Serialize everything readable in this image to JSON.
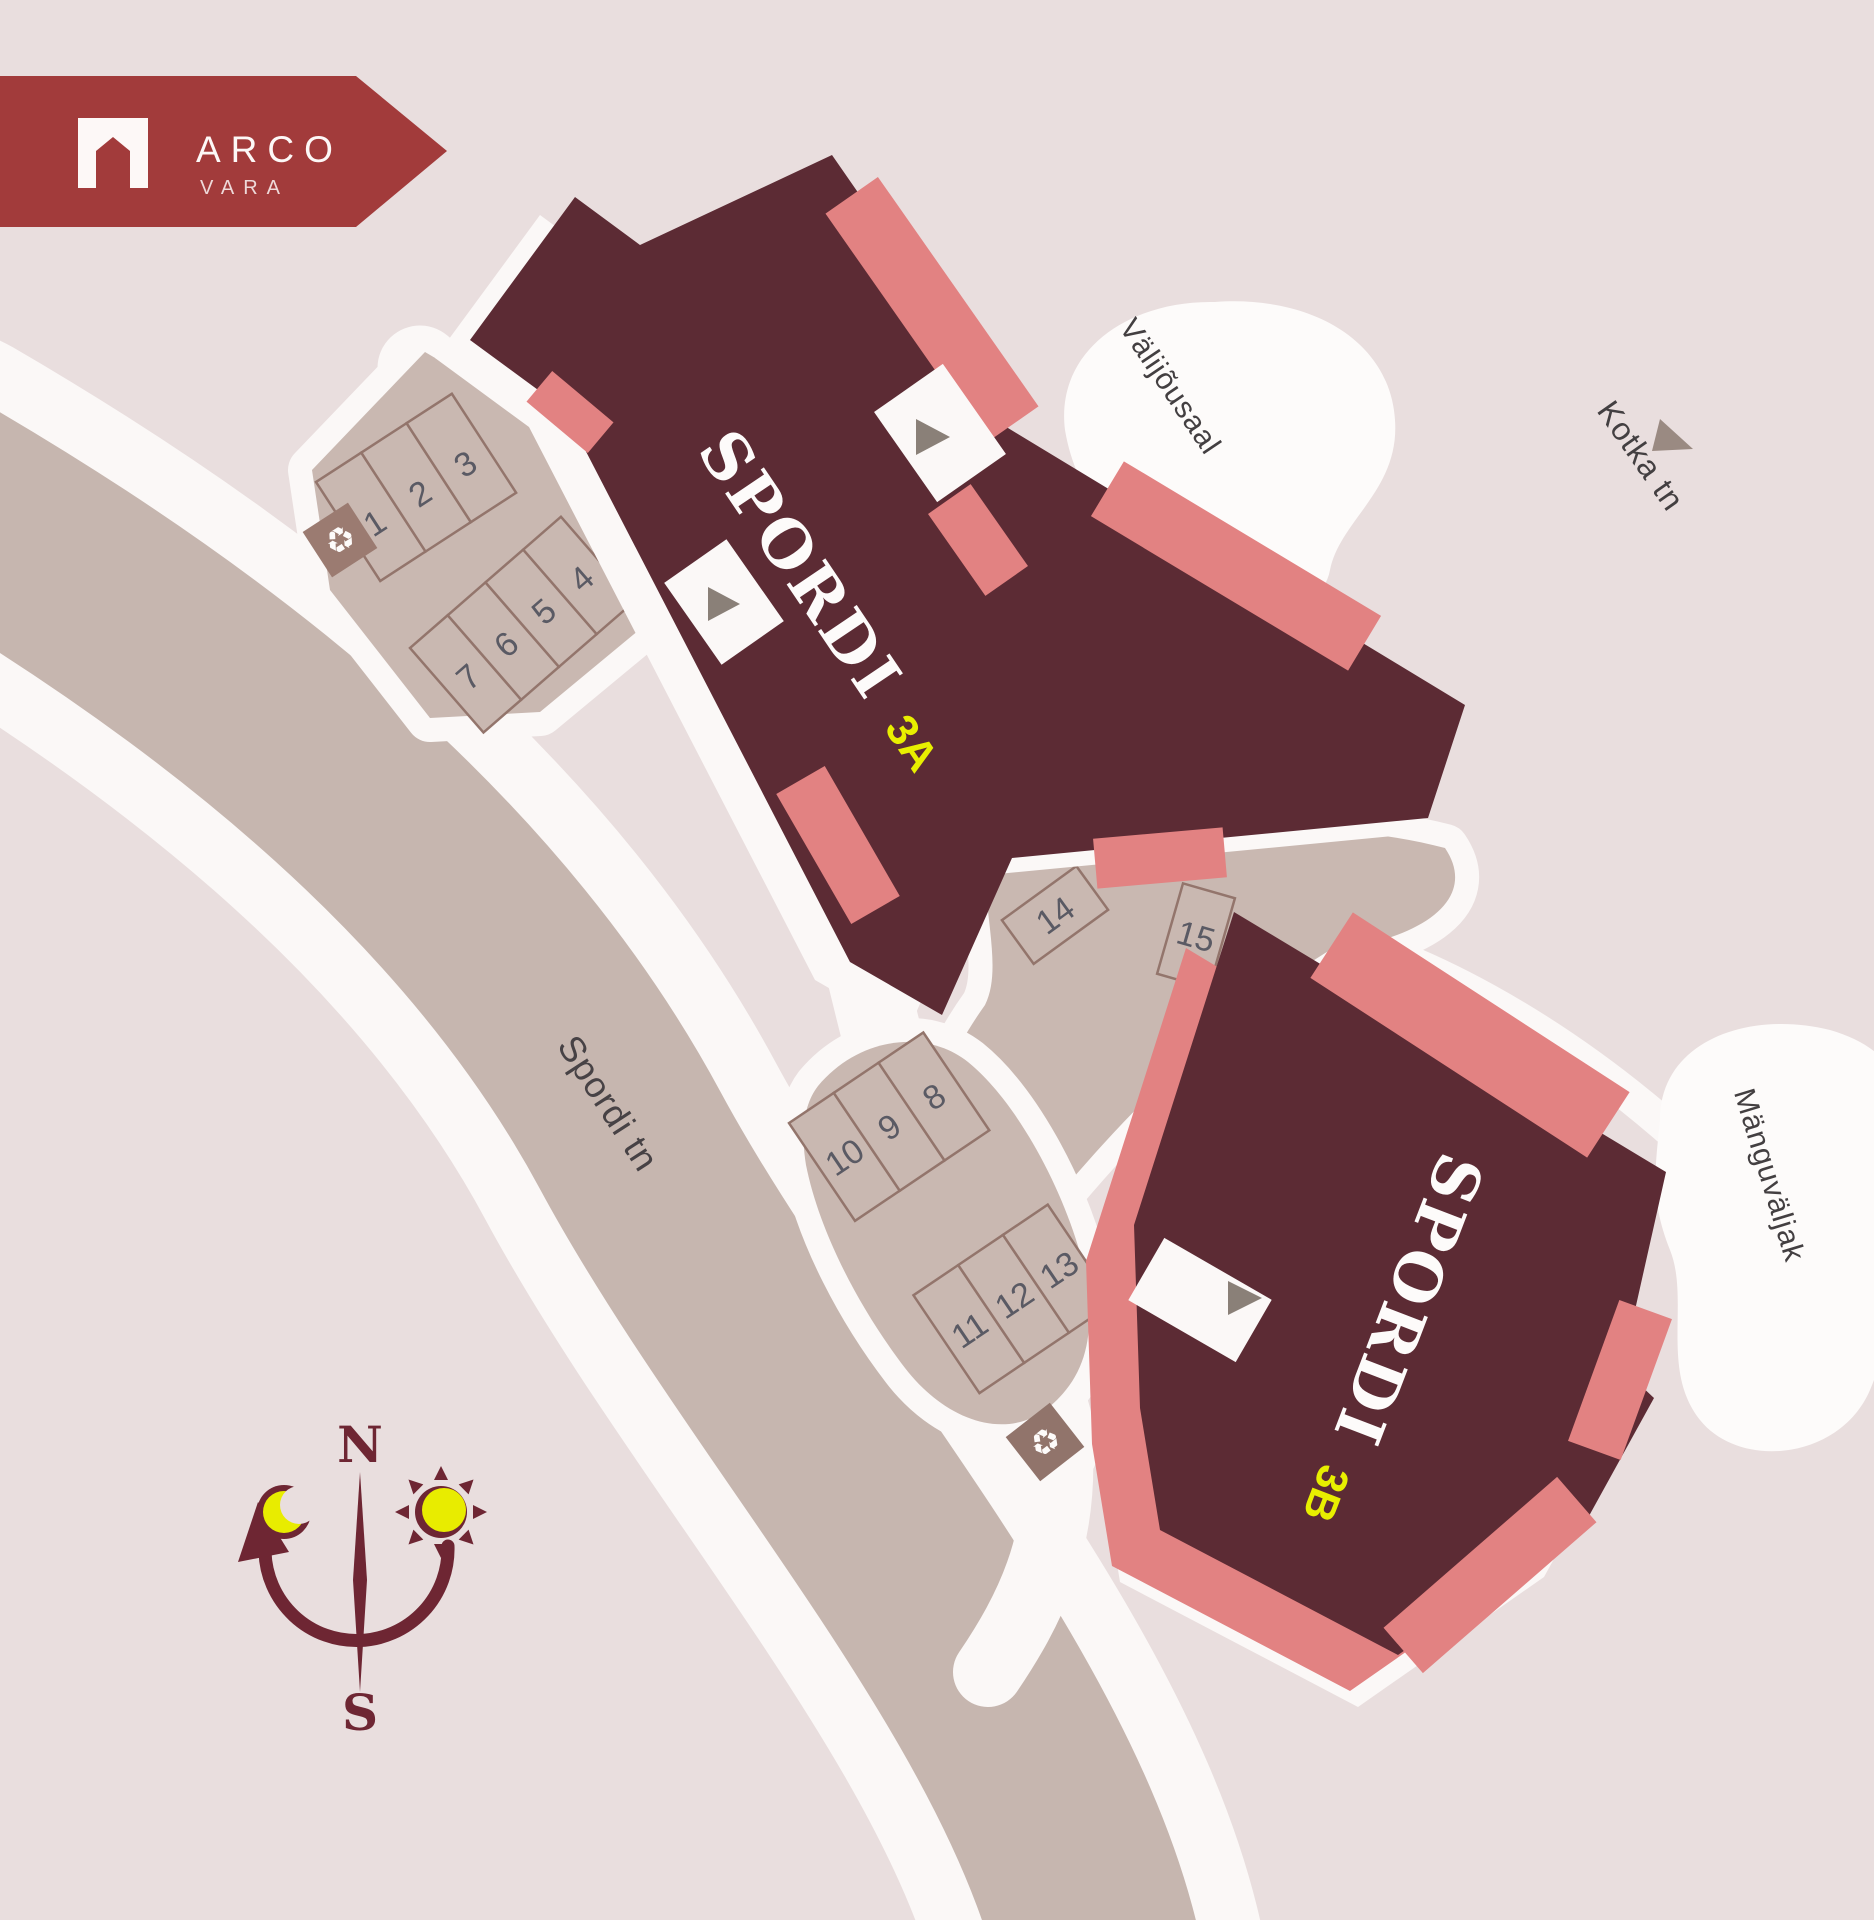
{
  "logo": {
    "brand": "ARCO",
    "sub": "VARA",
    "color": "#a23b3b",
    "icon": "house-icon"
  },
  "buildings": {
    "a": {
      "name": "SPORDI",
      "unit": "3A"
    },
    "b": {
      "name": "SPORDI",
      "unit": "3B"
    }
  },
  "parking": {
    "stalls": [
      "1",
      "2",
      "3",
      "4",
      "5",
      "6",
      "7",
      "8",
      "9",
      "10",
      "11",
      "12",
      "13",
      "14",
      "15"
    ]
  },
  "map_labels": {
    "outdoor_gym": "Välijõusaal",
    "kotka_street": "Kotka tn",
    "spordi_street": "Spordi tn",
    "playground": "Mänguväljak"
  },
  "compass": {
    "north": "N",
    "south": "S"
  },
  "icons": {
    "recycle": "♻",
    "entrance_arrow": "triangle-right",
    "sun": "sun-icon",
    "moon": "crescent-moon-icon"
  },
  "colors": {
    "background": "#e9dede",
    "road_beige": "#c6b6af",
    "parking_beige": "#c9b8b1",
    "path_white": "#fbf8f7",
    "building_maroon": "#5c2b34",
    "accent_salmon": "#e28282",
    "logo_red": "#a23b3b",
    "unit_yellow": "#e8ef00",
    "number_gray": "#5a5a64",
    "compass_maroon": "#6e2633"
  }
}
